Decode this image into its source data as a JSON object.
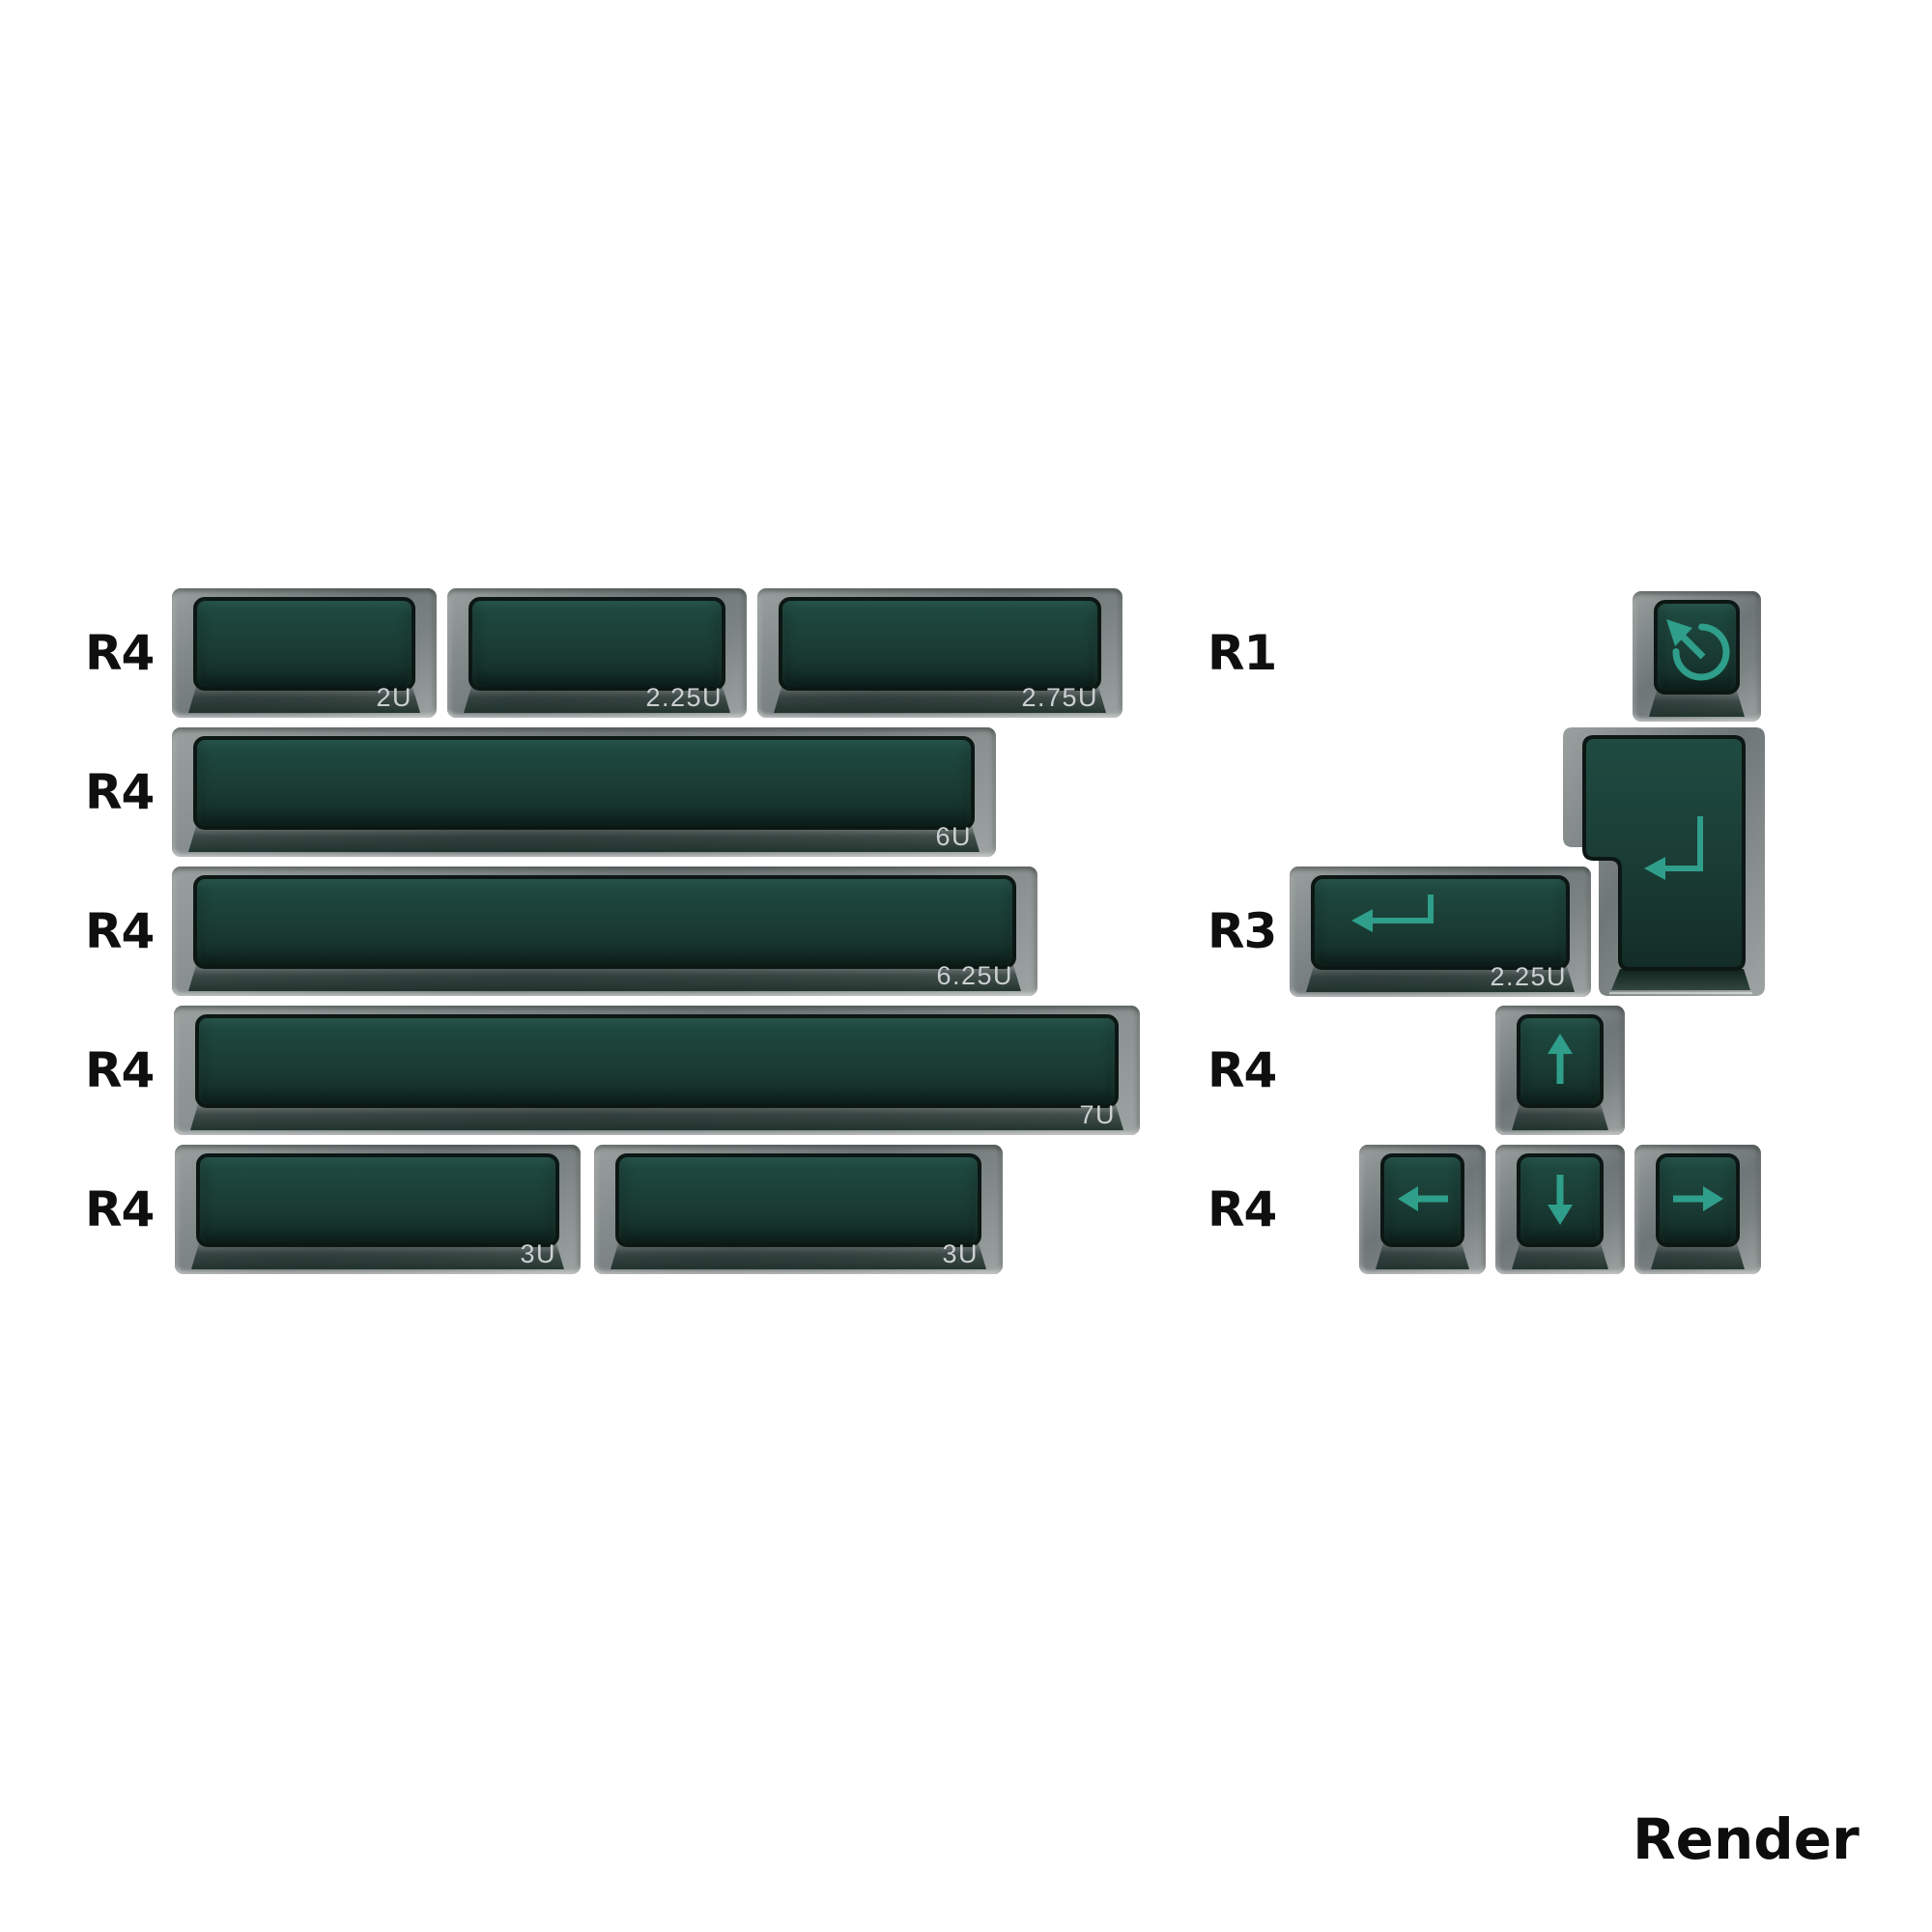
{
  "colors": {
    "legend": "#2f9e8a",
    "face_top": "#1f4b42",
    "face_bottom": "#132c26",
    "body_gray": "#7b8282",
    "size_label": "#ccd0d1",
    "row_label": "#0f0f0f",
    "background": "#ffffff"
  },
  "left_panel": {
    "rows": [
      {
        "row_label": "R4",
        "keys": [
          {
            "id": "r1-2u",
            "size_label": "2U"
          },
          {
            "id": "r1-225u",
            "size_label": "2.25U"
          },
          {
            "id": "r1-275u",
            "size_label": "2.75U"
          }
        ]
      },
      {
        "row_label": "R4",
        "keys": [
          {
            "id": "r2-6u",
            "size_label": "6U"
          }
        ]
      },
      {
        "row_label": "R4",
        "keys": [
          {
            "id": "r3-625u",
            "size_label": "6.25U"
          }
        ]
      },
      {
        "row_label": "R4",
        "keys": [
          {
            "id": "r4-7u",
            "size_label": "7U"
          }
        ]
      },
      {
        "row_label": "R4",
        "keys": [
          {
            "id": "r5-3u-a",
            "size_label": "3U"
          },
          {
            "id": "r5-3u-b",
            "size_label": "3U"
          }
        ]
      }
    ]
  },
  "right_panel": {
    "rows": [
      {
        "row_label": "R1",
        "keys": [
          {
            "id": "rr1-rotate",
            "legend": "rotate-ccw-icon"
          }
        ]
      },
      {
        "row_label": null,
        "keys": [
          {
            "id": "iso-enter",
            "legend": "return-icon",
            "shape": "iso-enter"
          }
        ]
      },
      {
        "row_label": "R3",
        "keys": [
          {
            "id": "rr3-225u",
            "size_label": "2.25U",
            "legend": "return-icon",
            "legend_align": "left"
          }
        ]
      },
      {
        "row_label": "R4",
        "keys": [
          {
            "id": "rr4-up",
            "legend": "arrow-up-icon"
          }
        ]
      },
      {
        "row_label": "R4",
        "keys": [
          {
            "id": "rr5-left",
            "legend": "arrow-left-icon"
          },
          {
            "id": "rr5-down",
            "legend": "arrow-down-icon"
          },
          {
            "id": "rr5-right",
            "legend": "arrow-right-icon"
          }
        ]
      }
    ]
  },
  "footer": {
    "label": "Render"
  }
}
